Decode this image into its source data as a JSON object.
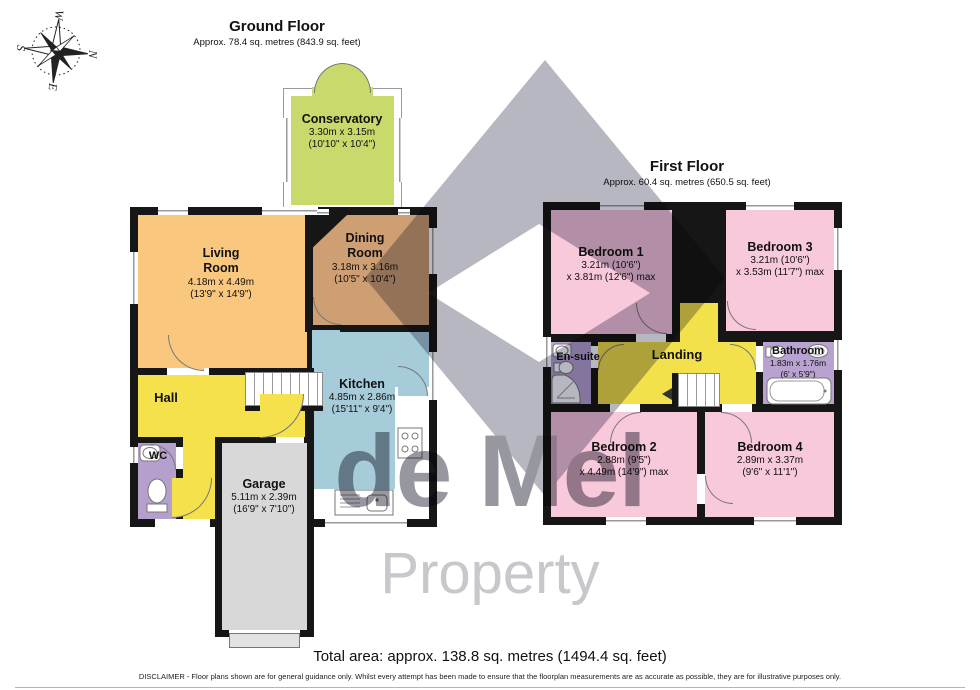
{
  "ground_floor": {
    "title": "Ground Floor",
    "subtitle": "Approx. 78.4 sq. metres (843.9 sq. feet)",
    "rooms": {
      "conservatory": {
        "name": "Conservatory",
        "dims1": "3.30m x 3.15m",
        "dims2": "(10'10\" x 10'4\")"
      },
      "living": {
        "name": "Living\nRoom",
        "dims1": "4.18m x 4.49m",
        "dims2": "(13'9\" x 14'9\")"
      },
      "dining": {
        "name": "Dining\nRoom",
        "dims1": "3.18m x 3.16m",
        "dims2": "(10'5\" x 10'4\")"
      },
      "kitchen": {
        "name": "Kitchen",
        "dims1": "4.85m x 2.86m",
        "dims2": "(15'11\" x 9'4\")"
      },
      "hall": {
        "name": "Hall"
      },
      "wc": {
        "name": "WC"
      },
      "garage": {
        "name": "Garage",
        "dims1": "5.11m x 2.39m",
        "dims2": "(16'9\" x 7'10\")"
      }
    }
  },
  "first_floor": {
    "title": "First Floor",
    "subtitle": "Approx. 60.4 sq. metres (650.5 sq. feet)",
    "rooms": {
      "bedroom1": {
        "name": "Bedroom 1",
        "dims1": "3.21m (10'6\")",
        "dims2": "x 3.81m (12'6\") max"
      },
      "bedroom3": {
        "name": "Bedroom 3",
        "dims1": "3.21m (10'6\")",
        "dims2": "x 3.53m (11'7\") max"
      },
      "ensuite": {
        "name": "En-suite"
      },
      "landing": {
        "name": "Landing"
      },
      "bathroom": {
        "name": "Bathroom",
        "dims1": "1.83m x 1.76m",
        "dims2": "(6' x 5'9\")"
      },
      "bedroom2": {
        "name": "Bedroom 2",
        "dims1": "2.88m (9'5\")",
        "dims2": "x 4.49m (14'9\") max"
      },
      "bedroom4": {
        "name": "Bedroom 4",
        "dims1": "2.89m x 3.37m",
        "dims2": "(9'6\" x 11'1\")"
      }
    }
  },
  "compass": {
    "n": "N",
    "e": "E",
    "s": "S",
    "w": "W"
  },
  "watermark": {
    "line1": "de Mel",
    "line2": "Property"
  },
  "footer": {
    "total_area": "Total area: approx. 138.8 sq. metres (1494.4 sq. feet)",
    "disclaimer": "DISCLAIMER -  Floor plans shown are for general guidance only. Whilst every attempt has been made to ensure that the floorplan measurements are as accurate as possible, they are for illustrative purposes only."
  },
  "colors": {
    "wall": "#161616",
    "conservatory": "#c9d96b",
    "living": "#f9c77e",
    "dining": "#cd9f72",
    "kitchen": "#a6cbd9",
    "hall": "#f5e14c",
    "wc": "#b49fcd",
    "garage": "#d8d8d8",
    "bedroom": "#f8c8db",
    "bathroom": "#b8a3d0",
    "landing": "#f3e14c",
    "watermark_grey": "#b7b7c2",
    "watermark_text": "#97979f"
  }
}
